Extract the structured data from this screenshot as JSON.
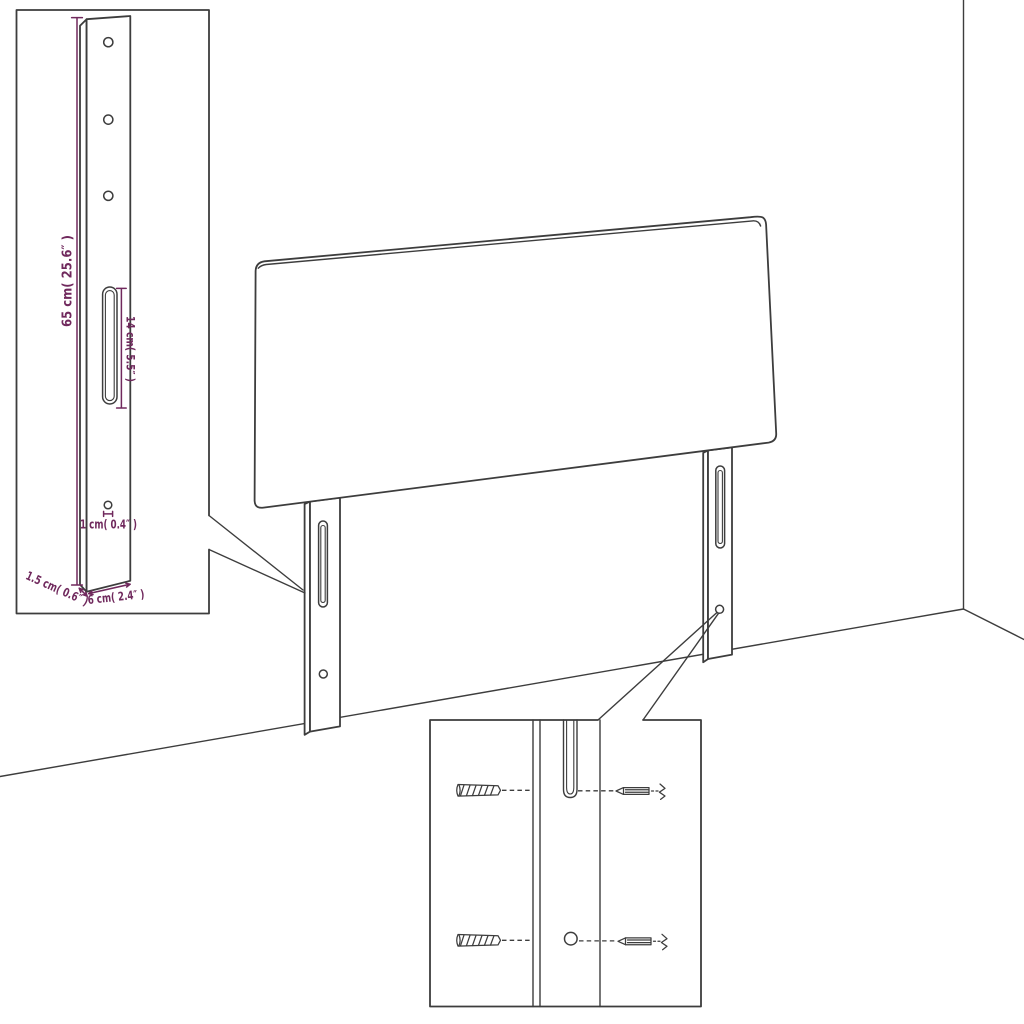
{
  "colors": {
    "background": "#ffffff",
    "line": "#3d3d3d",
    "dimension": "#70295d"
  },
  "leg_detail_inset": {
    "height_label": "65 cm( 25.6″ )",
    "slot_label": "14 cm( 5.5″ )",
    "hole_label": "1 cm( 0.4″ )",
    "thickness_label": "1.5 cm( 0.6″ )",
    "width_label": "6 cm( 2.4″ )"
  }
}
